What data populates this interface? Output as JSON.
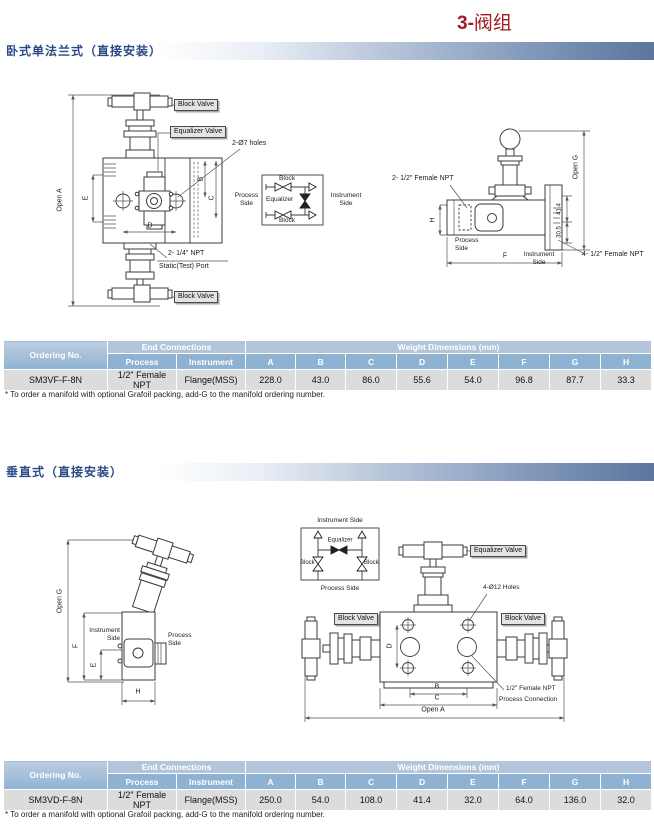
{
  "title": {
    "prefix": "3-",
    "name": "阀组"
  },
  "s1": {
    "heading": "卧式单法兰式（直接安装）",
    "left": {
      "block_valve_top": "Block Valve",
      "block_valve_bottom": "Block Valve",
      "equalizer_valve": "Equalizer Valve",
      "holes": "2-Ø7 holes",
      "npt_line1": "2- 1/4\" NPT",
      "npt_line2": "Static(Test) Port",
      "open_a": "Open A",
      "dim_e": "E",
      "dim_d": "D",
      "dim_b": "B",
      "dim_c": "C"
    },
    "schematic": {
      "process_side": "Process Side",
      "instrument_side": "Instrument Side",
      "block_top": "Block",
      "block_bottom": "Block",
      "equalizer": "Equalizer"
    },
    "right": {
      "npt_2x": "2- 1/2\" Female NPT",
      "npt_4x": "4- 1/2\" Female NPT",
      "open_g": "Open G",
      "dim_h": "H",
      "dim_f": "F",
      "dim_414": "41.4",
      "dim_305": "30.5",
      "process_side": "Process Side",
      "instrument_side": "Instrument Side"
    },
    "table": {
      "ordering_header": "Ordering No.",
      "end_connections": "End Connections",
      "weight_dims": "Weight Dimensions (mm)",
      "process": "Process",
      "instrument": "Instrument",
      "dims": [
        "A",
        "B",
        "C",
        "D",
        "E",
        "F",
        "G",
        "H"
      ],
      "row": {
        "ordering": "SM3VF-F-8N",
        "process": "1/2\" Female NPT",
        "instrument": "Flange(MSS)",
        "values": [
          "228.0",
          "43.0",
          "86.0",
          "55.6",
          "54.0",
          "96.8",
          "87.7",
          "33.3"
        ]
      }
    },
    "footnote": "* To order a manifold with optional Grafoil packing, add-G to the manifold ordering number."
  },
  "s2": {
    "heading": "垂直式（直接安装）",
    "left": {
      "open_g": "Open G",
      "dim_f": "F",
      "dim_e": "E",
      "dim_h": "H",
      "instrument_side": "Instrument Side",
      "process_side": "Process Side"
    },
    "schematic": {
      "instrument_side": "Instrument Side",
      "process_side": "Process Side",
      "equalizer": "Equalizer",
      "block_left": "Block",
      "block_right": "Block"
    },
    "right": {
      "equalizer_valve": "Equalizer Valve",
      "holes": "4-Ø12 Holes",
      "block_valve_left": "Block Valve",
      "block_valve_right": "Block Valve",
      "dim_d": "D",
      "dim_b": "B",
      "dim_c": "C",
      "open_a": "Open A",
      "npt_line1": "1/2\" Female NPT",
      "npt_line2": "Process Connection"
    },
    "table": {
      "ordering_header": "Ordering No.",
      "end_connections": "End Connections",
      "weight_dims": "Weight Dimensions (mm)",
      "process": "Process",
      "instrument": "Instrument",
      "dims": [
        "A",
        "B",
        "C",
        "D",
        "E",
        "F",
        "G",
        "H"
      ],
      "row": {
        "ordering": "SM3VD-F-8N",
        "process": "1/2\" Female NPT",
        "instrument": "Flange(MSS)",
        "values": [
          "250.0",
          "54.0",
          "108.0",
          "41.4",
          "32.0",
          "64.0",
          "136.0",
          "32.0"
        ]
      }
    },
    "footnote": "* To order a manifold with optional Grafoil packing, add-G to the manifold ordering number."
  },
  "colors": {
    "title_red": "#9e1c22",
    "heading_blue": "#2a4a87",
    "header_row1_bg": "#b3c5da",
    "header_row2_bg": "#8fb2d3",
    "data_row_bg": "#dcdcdc"
  }
}
